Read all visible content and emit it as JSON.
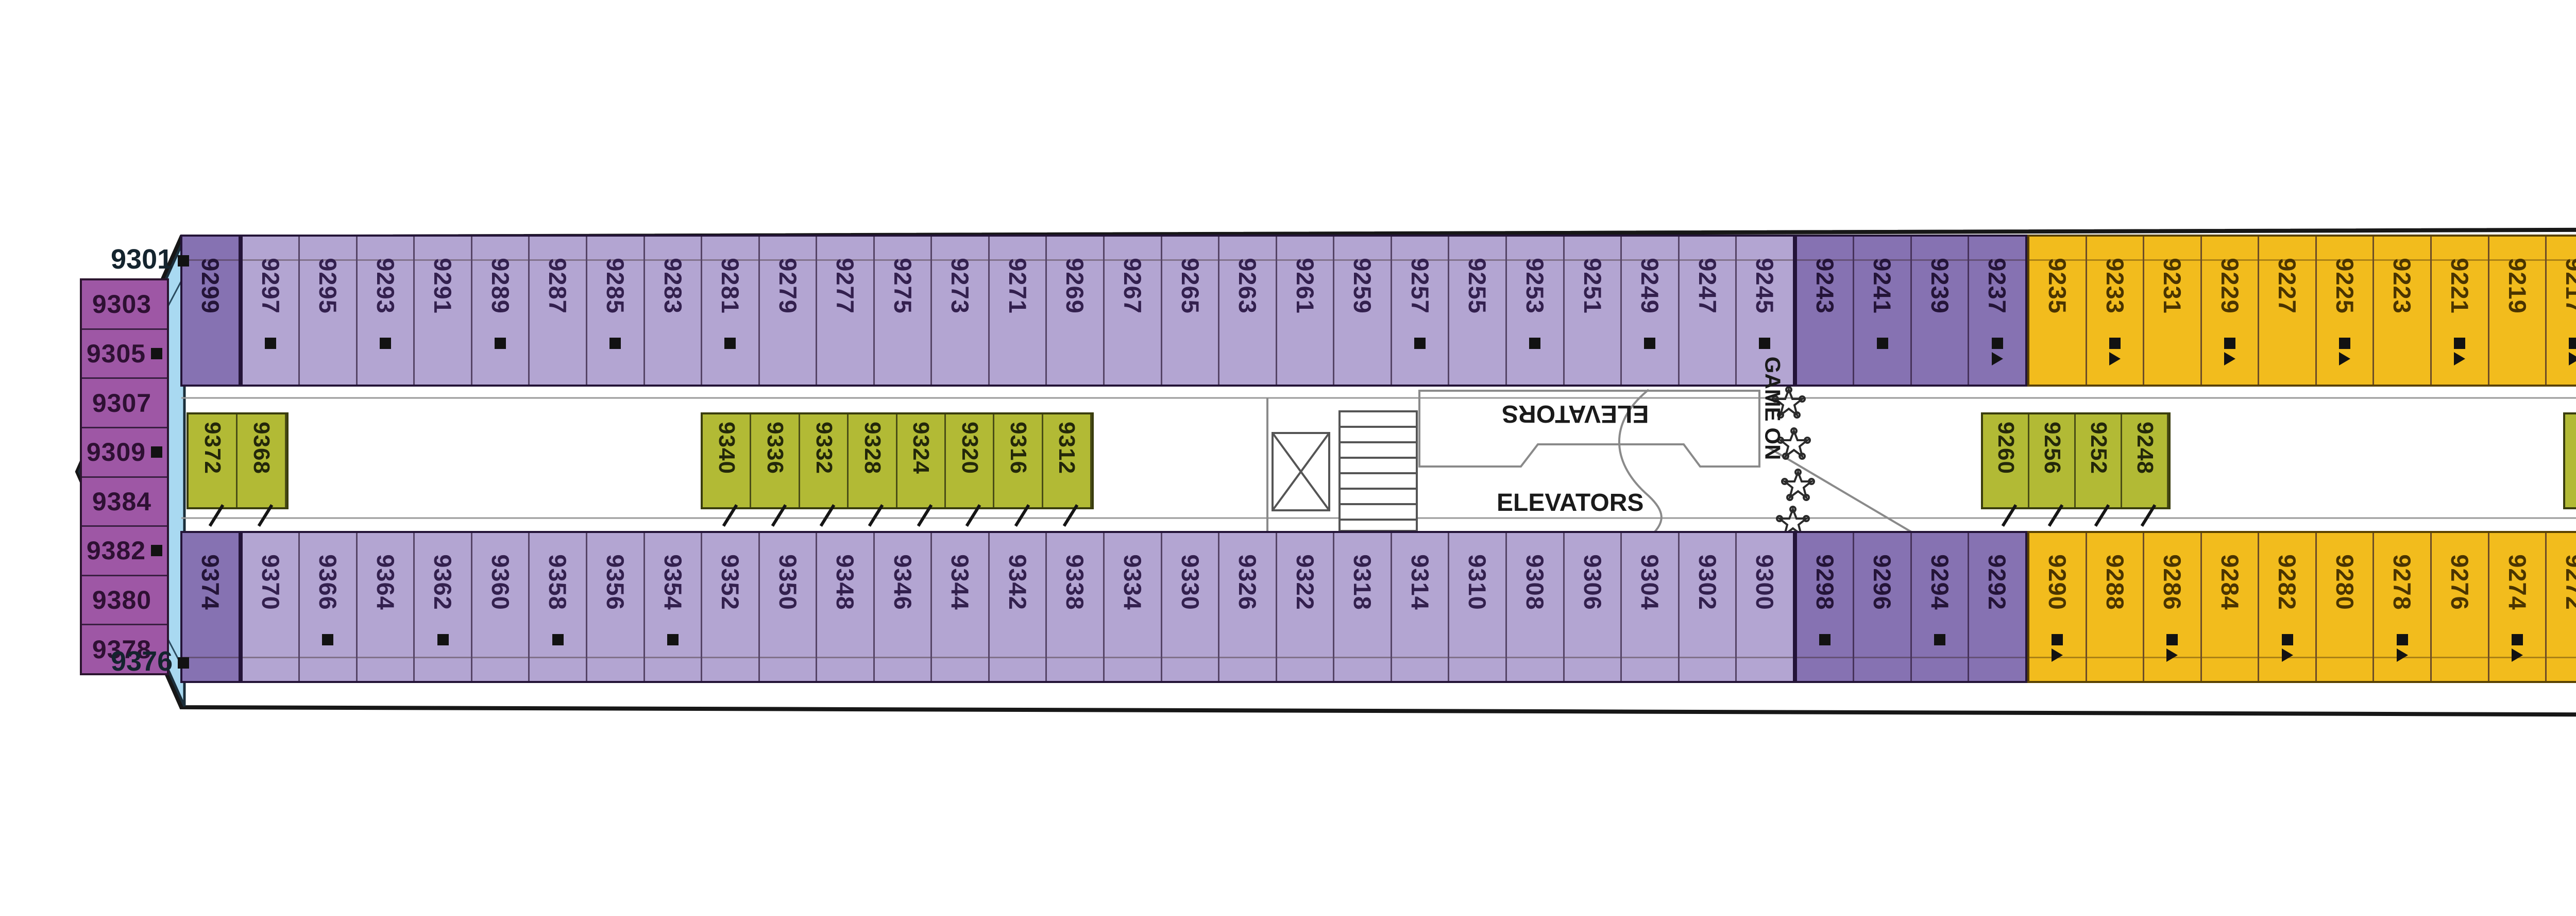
{
  "colors": {
    "light-purple": "#b3a5d2",
    "dark-purple": "#8672b2",
    "plum": "#9e57a5",
    "light-blue": "#a9d9f1",
    "yellow": "#f2bc1d",
    "orange": "#ee8f1e",
    "green": "#b2ba35"
  },
  "labels": {
    "elevators_mid_top": "ELEVATORS",
    "elevators_mid_bottom": "ELEVATORS",
    "elevators_right": "ELEVATORS",
    "game_on": "GAME ON"
  },
  "bow": {
    "tip_top": "9301",
    "tip_bottom": "9376",
    "column": [
      "9303",
      "9305",
      "9307",
      "9309",
      "9384",
      "9382",
      "9380",
      "9378"
    ]
  },
  "top_row": {
    "groups": [
      {
        "style": "dp",
        "cabins": [
          "9299"
        ]
      },
      {
        "style": "lp",
        "cabins": [
          "9297",
          "9295",
          "9293",
          "9291",
          "9289",
          "9287",
          "9285",
          "9283",
          "9281",
          "9279",
          "9277",
          "9275",
          "9273",
          "9271",
          "9269",
          "9267",
          "9265",
          "9263",
          "9261",
          "9259",
          "9257",
          "9255",
          "9253",
          "9251",
          "9249",
          "9247",
          "9245"
        ]
      },
      {
        "style": "dp",
        "cabins": [
          "9243",
          "9241",
          "9239",
          "9237"
        ]
      },
      {
        "style": "y",
        "cabins": [
          "9235",
          "9233",
          "9231",
          "9229",
          "9227",
          "9225",
          "9223",
          "9221",
          "9219",
          "9217"
        ]
      },
      {
        "style": "o",
        "cabins": [
          "9215",
          "9211",
          "9209",
          "9207"
        ]
      },
      {
        "style": "y",
        "cabins": [
          "9205",
          "9203",
          "9201",
          "9199",
          "9197",
          "9195",
          "9193",
          "9191",
          "9189",
          "9187",
          "9185",
          "9183",
          "9181",
          "9179",
          "9177",
          "9175",
          "9173",
          "9171",
          "9169",
          "9167",
          "9165",
          "9163",
          "9161",
          "9159"
        ]
      },
      {
        "style": "o",
        "cabins": [
          "9157",
          "9155"
        ]
      },
      {
        "style": "y",
        "cabins": [
          "9153",
          "9151",
          "9149",
          "9147",
          "9145",
          "9143",
          "9141",
          "9139",
          "9137",
          "9135",
          "9133",
          "9131",
          "9129",
          "9127",
          "9125",
          "9123",
          "9121",
          "9109",
          "9107",
          "9105",
          "9103",
          "9101"
        ]
      }
    ]
  },
  "bottom_row": {
    "groups": [
      {
        "style": "dp",
        "cabins": [
          "9374"
        ]
      },
      {
        "style": "lp",
        "cabins": [
          "9370",
          "9366",
          "9364",
          "9362",
          "9360",
          "9358",
          "9356",
          "9354",
          "9352",
          "9350",
          "9348",
          "9346",
          "9344",
          "9342",
          "9338",
          "9334",
          "9330",
          "9326",
          "9322",
          "9318",
          "9314",
          "9310",
          "9308",
          "9306",
          "9304",
          "9302",
          "9300"
        ]
      },
      {
        "style": "dp",
        "cabins": [
          "9298",
          "9296",
          "9294",
          "9292"
        ]
      },
      {
        "style": "y",
        "cabins": [
          "9290",
          "9288",
          "9286",
          "9284",
          "9282",
          "9280",
          "9278",
          "9276",
          "9274",
          "9272"
        ]
      },
      {
        "style": "o",
        "cabins": [
          "9270",
          "9268",
          "9266",
          "9264"
        ]
      },
      {
        "style": "y",
        "cabins": [
          "9262",
          "9258",
          "9254",
          "9250",
          "9246",
          "9244",
          "9242",
          "9240",
          "9238",
          "9236",
          "9234",
          "9232",
          "9230",
          "9228",
          "9226",
          "9224",
          "9222",
          "9218",
          "9214",
          "9210",
          "9208",
          "9204",
          "9200",
          "9198"
        ]
      },
      {
        "style": "o",
        "cabins": [
          "9194",
          "9192"
        ]
      },
      {
        "style": "y",
        "cabins": [
          "9190",
          "9188",
          "9186",
          "9184",
          "9182",
          "9180",
          "9178",
          "9176",
          "9138",
          "9136",
          "9134",
          "9132",
          "9130",
          "9128",
          "9126",
          "9124",
          "9122",
          "9120",
          "9108",
          "9106",
          "9104",
          "9102"
        ]
      }
    ]
  },
  "mid_bands": {
    "A": [
      "9372",
      "9368"
    ],
    "B": [
      "9340",
      "9336",
      "9332",
      "9328",
      "9324",
      "9320",
      "9316",
      "9312"
    ],
    "C": [
      "9260",
      "9256",
      "9252",
      "9248"
    ],
    "D": [
      "9220",
      "9216",
      "9212",
      "9206",
      "9202",
      "9196"
    ]
  },
  "right_cluster": {
    "horizontal": [
      "9142",
      "9146",
      "9158",
      "9164"
    ],
    "single": "9140",
    "band": [
      "9144",
      "9148",
      "9150",
      "9152",
      "9154",
      "9156",
      "9160",
      "9162",
      "9166",
      "9168",
      "9170",
      "9172",
      "9174"
    ]
  },
  "markers": {
    "squares": [
      "9301",
      "9305",
      "9309",
      "9382",
      "9376",
      "9297",
      "9293",
      "9289",
      "9285",
      "9281",
      "9257",
      "9253",
      "9249",
      "9245",
      "9241",
      "9237",
      "9233",
      "9229",
      "9225",
      "9221",
      "9217",
      "9211",
      "9207",
      "9203",
      "9199",
      "9195",
      "9171",
      "9167",
      "9163",
      "9159",
      "9155",
      "9151",
      "9147",
      "9366",
      "9362",
      "9358",
      "9354",
      "9298",
      "9294",
      "9290",
      "9286",
      "9282",
      "9278",
      "9274",
      "9270",
      "9266",
      "9262",
      "9254",
      "9246",
      "9222",
      "9214",
      "9208",
      "9200",
      "9194",
      "9190",
      "9186"
    ],
    "triangles": [
      "9237",
      "9233",
      "9229",
      "9225",
      "9221",
      "9217",
      "9191",
      "9187",
      "9183",
      "9179",
      "9175",
      "9171",
      "9167",
      "9163",
      "9159",
      "9155",
      "9151",
      "9147",
      "9290",
      "9286",
      "9282",
      "9278",
      "9274",
      "9270",
      "9242",
      "9238",
      "9234",
      "9230",
      "9226",
      "9222",
      "9214",
      "9208",
      "9200",
      "9194",
      "9190",
      "9186"
    ],
    "wheelchair": [
      "9206",
      "9202",
      "9196"
    ]
  }
}
